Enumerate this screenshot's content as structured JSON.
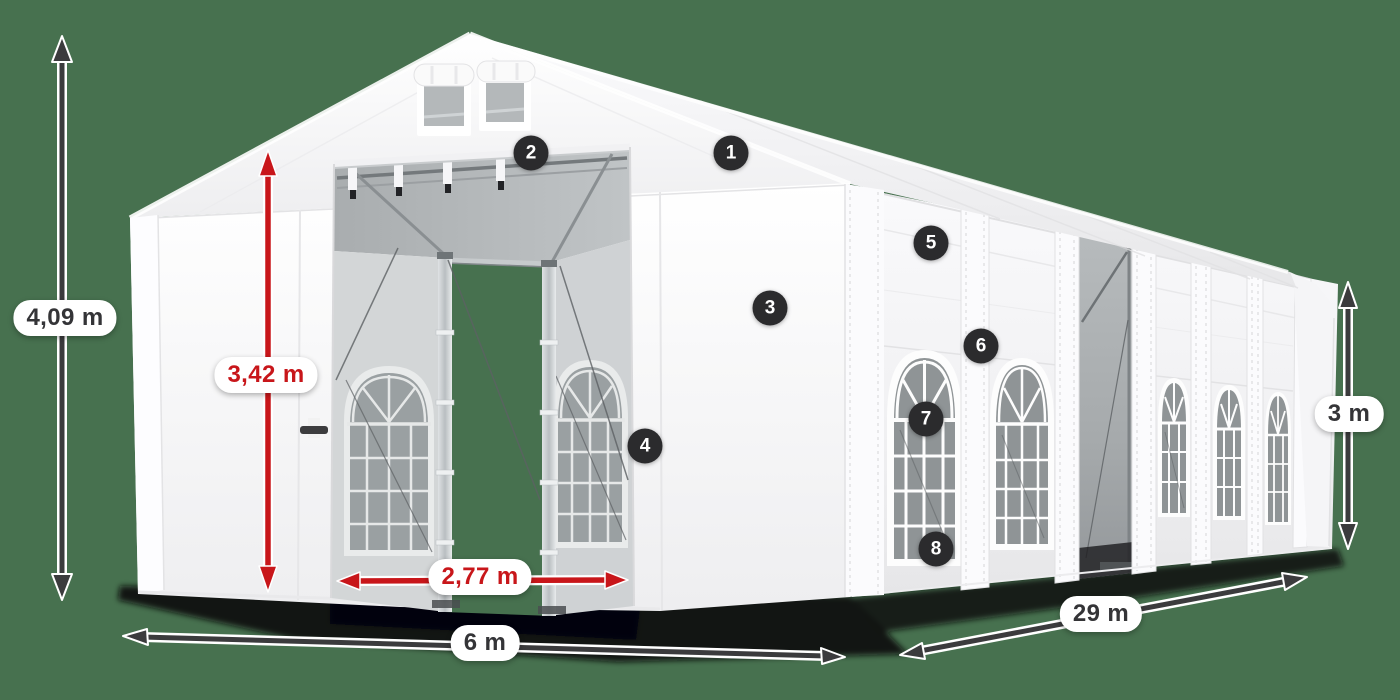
{
  "scene": {
    "subject": "White storage marquee tent (6 m x 29 m) product illustration with dimension arrows and numbered feature callouts",
    "background_color": "#47714f"
  },
  "colors": {
    "accent_red": "#c8161a",
    "annotation_dark": "#3b3b3d",
    "badge_background": "#2b2b2d",
    "pill_background": "#ffffff",
    "tent_white": "#f4f4f6",
    "window_glass": "#8f9496"
  },
  "dimensions": {
    "total_height": {
      "label": "4,09 m",
      "style": "dark"
    },
    "entrance_height": {
      "label": "3,42 m",
      "style": "red"
    },
    "entrance_width": {
      "label": "2,77 m",
      "style": "red"
    },
    "width": {
      "label": "6 m",
      "style": "dark"
    },
    "length": {
      "label": "29 m",
      "style": "dark"
    },
    "side_height": {
      "label": "3 m",
      "style": "dark"
    }
  },
  "callouts": [
    {
      "number": "1"
    },
    {
      "number": "2"
    },
    {
      "number": "3"
    },
    {
      "number": "4"
    },
    {
      "number": "5"
    },
    {
      "number": "6"
    },
    {
      "number": "7"
    },
    {
      "number": "8"
    }
  ]
}
